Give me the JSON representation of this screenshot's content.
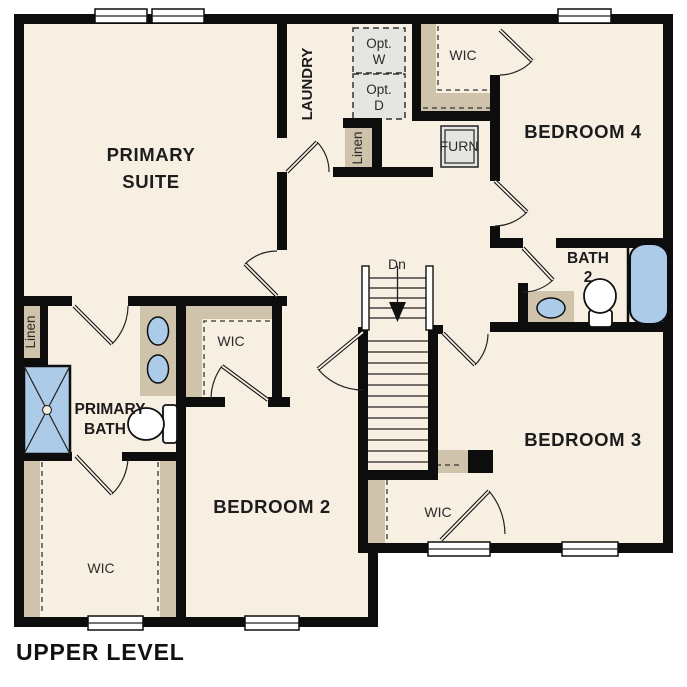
{
  "plan_title": "UPPER LEVEL",
  "colors": {
    "background": "#ffffff",
    "wall": "#0d0d0d",
    "floor": "#f8efe3",
    "shelf_tan": "#cfc3ab",
    "fixture_blue": "#abcbe9",
    "appliance_gray": "#e5e5e2"
  },
  "labels": {
    "primary_suite_line1": "PRIMARY",
    "primary_suite_line2": "SUITE",
    "laundry": "LAUNDRY",
    "opt_w_line1": "Opt.",
    "opt_w_line2": "W",
    "opt_d_line1": "Opt.",
    "opt_d_line2": "D",
    "wic_bedroom4": "WIC",
    "bedroom4": "BEDROOM 4",
    "furnace": "FURN",
    "linen_laundry": "Linen",
    "linen_hall": "Linen",
    "stairs_direction": "Dn",
    "bath2_line1": "BATH",
    "bath2_line2": "2",
    "wic_primary": "WIC",
    "primary_bath_line1": "PRIMARY",
    "primary_bath_line2": "BATH",
    "bedroom2": "BEDROOM 2",
    "wic_lower_left": "WIC",
    "bedroom3": "BEDROOM 3",
    "wic_bedroom3": "WIC"
  }
}
